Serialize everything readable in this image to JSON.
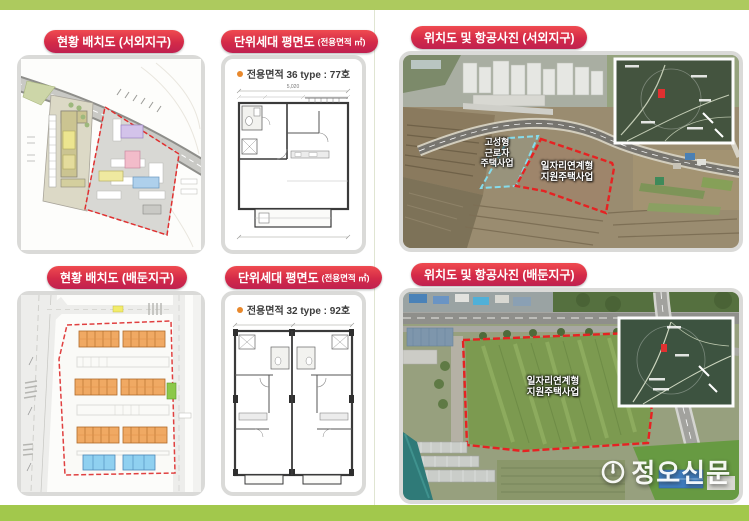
{
  "badges": {
    "site_plan_seooe": "현황 배치도 (서외지구)",
    "unit_plan": "단위세대 평면도",
    "unit_plan_sub": "(전용면적 ㎡)",
    "aerial_seooe": "위치도 및 항공사진 (서외지구)",
    "site_plan_baedun": "현황 배치도 (배둔지구)",
    "aerial_baedun": "위치도 및 항공사진 (배둔지구)"
  },
  "floor_plans": {
    "top": {
      "caption": "전용면적 36 type : 77호",
      "dimension": "5,020"
    },
    "bottom": {
      "caption": "전용면적 32 type : 92호"
    }
  },
  "aerials": {
    "seooe": {
      "worker_label": "고성형\n근로자\n주택사업",
      "job_label": "일자리연계형\n지원주택사업"
    },
    "baedun": {
      "job_label": "일자리연계형\n지원주택사업"
    }
  },
  "watermark": {
    "text": "정오신문"
  },
  "colors": {
    "band_green_top": "#adca5e",
    "band_green_bottom": "#a2c84c",
    "badge_red": "#d42a48",
    "bullet_orange": "#e8882c",
    "boundary_red": "#e62222",
    "boundary_cyan": "#85dcec",
    "panel_border": "#dadad8"
  }
}
